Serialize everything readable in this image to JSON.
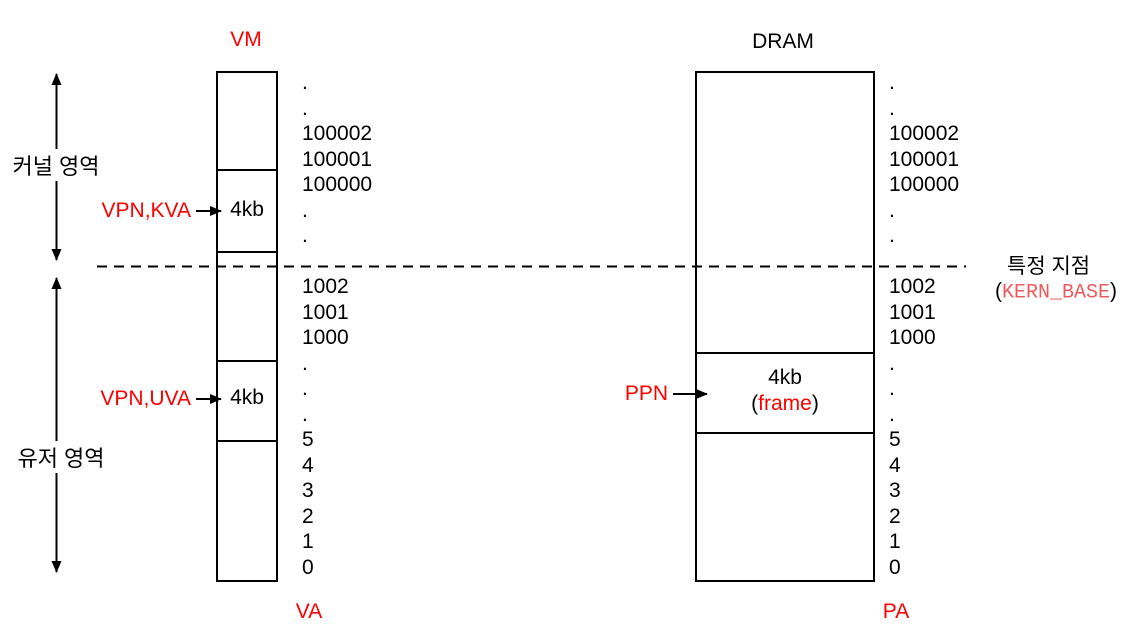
{
  "titles": {
    "vm": "VM",
    "dram": "DRAM",
    "va": "VA",
    "pa": "PA"
  },
  "regions": {
    "kernel_label": "커널 영역",
    "user_label": "유저 영역"
  },
  "vm": {
    "kva_pointer_label": "VPN,KVA",
    "kva_page_size": "4kb",
    "uva_pointer_label": "VPN,UVA",
    "uva_page_size": "4kb",
    "index_lines": [
      ".",
      ".",
      "100002",
      "100001",
      "100000",
      ".",
      ".",
      "",
      "1002",
      "1001",
      "1000",
      ".",
      ".",
      ".",
      "5",
      "4",
      "3",
      "2",
      "1",
      "0"
    ]
  },
  "dram": {
    "ppn_pointer_label": "PPN",
    "frame_size": "4kb",
    "frame_open_paren": "(",
    "frame_name": "frame",
    "frame_close_paren": ")",
    "index_lines": [
      ".",
      ".",
      "100002",
      "100001",
      "100000",
      ".",
      ".",
      "",
      "1002",
      "1001",
      "1000",
      ".",
      ".",
      ".",
      "5",
      "4",
      "3",
      "2",
      "1",
      "0"
    ]
  },
  "kern_base": {
    "point_label": "특정 지점",
    "open_paren": "(",
    "name": "KERN_BASE",
    "close_paren": ")"
  },
  "colors": {
    "annotation_red": "#FF0000",
    "kern_base_red": "#ED5B5B",
    "line_black": "#000000",
    "background": "#FFFFFF"
  }
}
